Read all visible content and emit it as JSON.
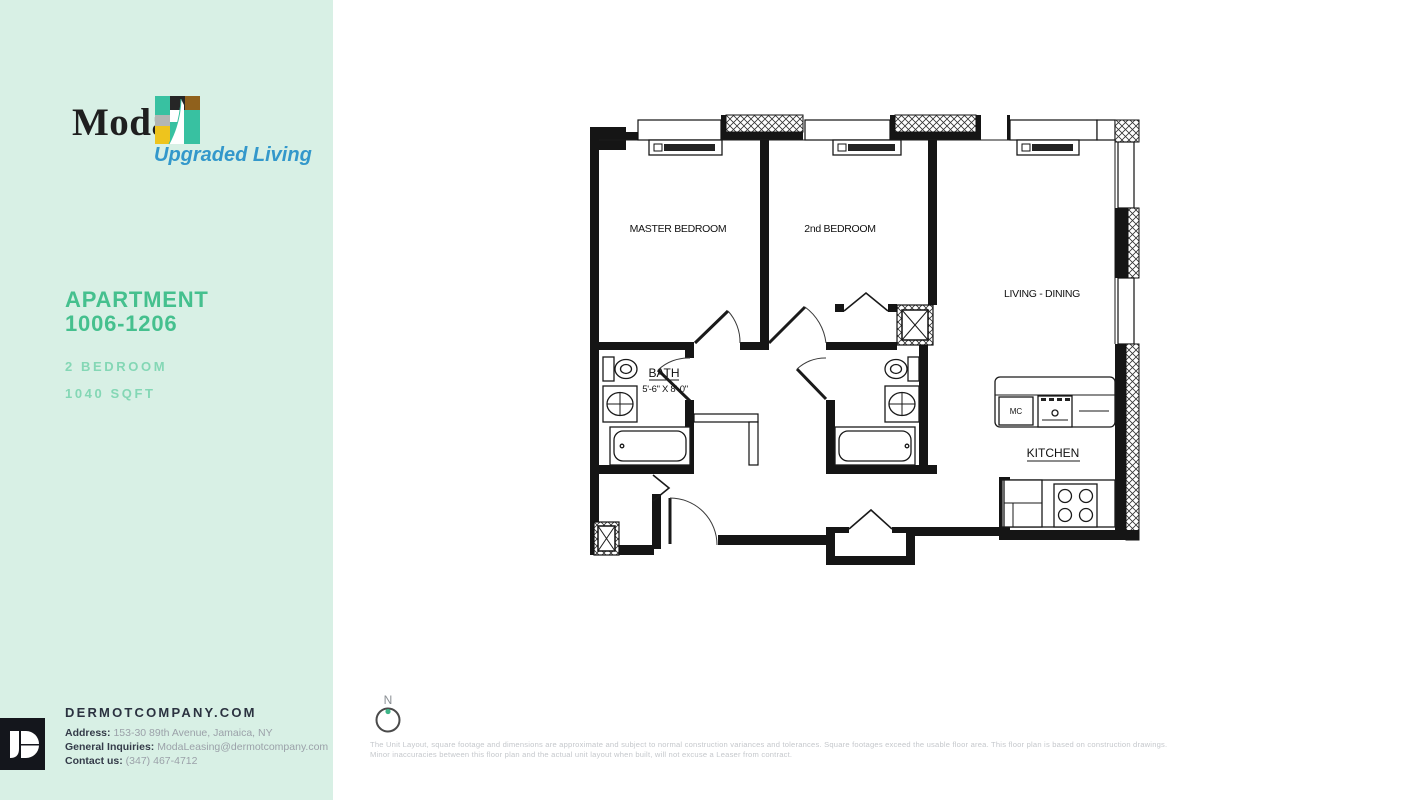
{
  "sidebar": {
    "brand": {
      "name": "Moda",
      "tagline": "Upgraded Living"
    },
    "apartment": {
      "title_line1": "APARTMENT",
      "title_line2": "1006-1206",
      "bedrooms": "2 BEDROOM",
      "area": "1040 SQFT"
    },
    "footer": {
      "website": "DERMOTCOMPANY.COM",
      "address_label": "Address:",
      "address": "153-30 89th Avenue, Jamaica, NY",
      "inquiries_label": "General Inquiries:",
      "inquiries": "ModaLeasing@dermotcompany.com",
      "contact_label": "Contact us:",
      "contact": "(347) 467-4712"
    }
  },
  "floorplan": {
    "rooms": {
      "master_bedroom": "MASTER BEDROOM",
      "second_bedroom": "2nd BEDROOM",
      "living_dining": "LIVING - DINING",
      "bath": "BATH",
      "bath_dimensions": "5'-6\" X 8'-0\"",
      "kitchen": "KITCHEN",
      "microwave": "MC"
    },
    "compass": {
      "label": "N"
    }
  },
  "disclaimer": {
    "line1": "The Unit Layout, square footage and dimensions are approximate and subject to normal construction variances and tolerances. Square footages exceed the usable floor area. This floor plan is based on construction drawings.",
    "line2": "Minor inaccuracies between this floor plan and the actual unit layout when built, will not excuse a Leaser from contract."
  },
  "colors": {
    "sidebar_bg": "#d8f0e5",
    "accent_green": "#45c08e",
    "light_green": "#84d7b5",
    "tagline_blue": "#3398cb",
    "dark_text": "#2b3240",
    "muted_gray": "#9ba1a9",
    "compass_dot": "#3db487"
  }
}
